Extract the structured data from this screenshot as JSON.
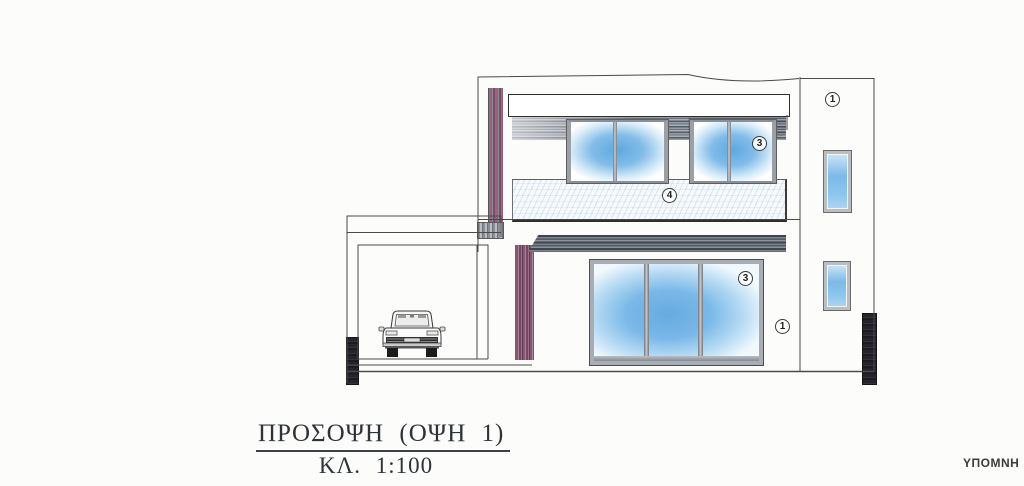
{
  "title_block": {
    "title": "ΠΡΟΣΟΨΗ (ΟΨΗ 1)",
    "scale": "ΚΛ. 1:100"
  },
  "legend": {
    "heading": "ΥΠΟΜΝΗ"
  },
  "markers": [
    {
      "label": "1",
      "location": "upper right return wall"
    },
    {
      "label": "3",
      "location": "first floor window"
    },
    {
      "label": "4",
      "location": "balcony parapet"
    },
    {
      "label": "3",
      "location": "ground floor sliding door"
    },
    {
      "label": "1",
      "location": "ground floor wall"
    }
  ],
  "colors": {
    "glazing_blue": "#6fb0e4",
    "glazing_pale": "#d8ecf9",
    "shadow_plum": "#91607a",
    "slab_gray": "#6a7078",
    "parapet_tint": "#eef5f9",
    "plinth_dark": "#26242a",
    "line_ink": "#3c3c3c"
  }
}
